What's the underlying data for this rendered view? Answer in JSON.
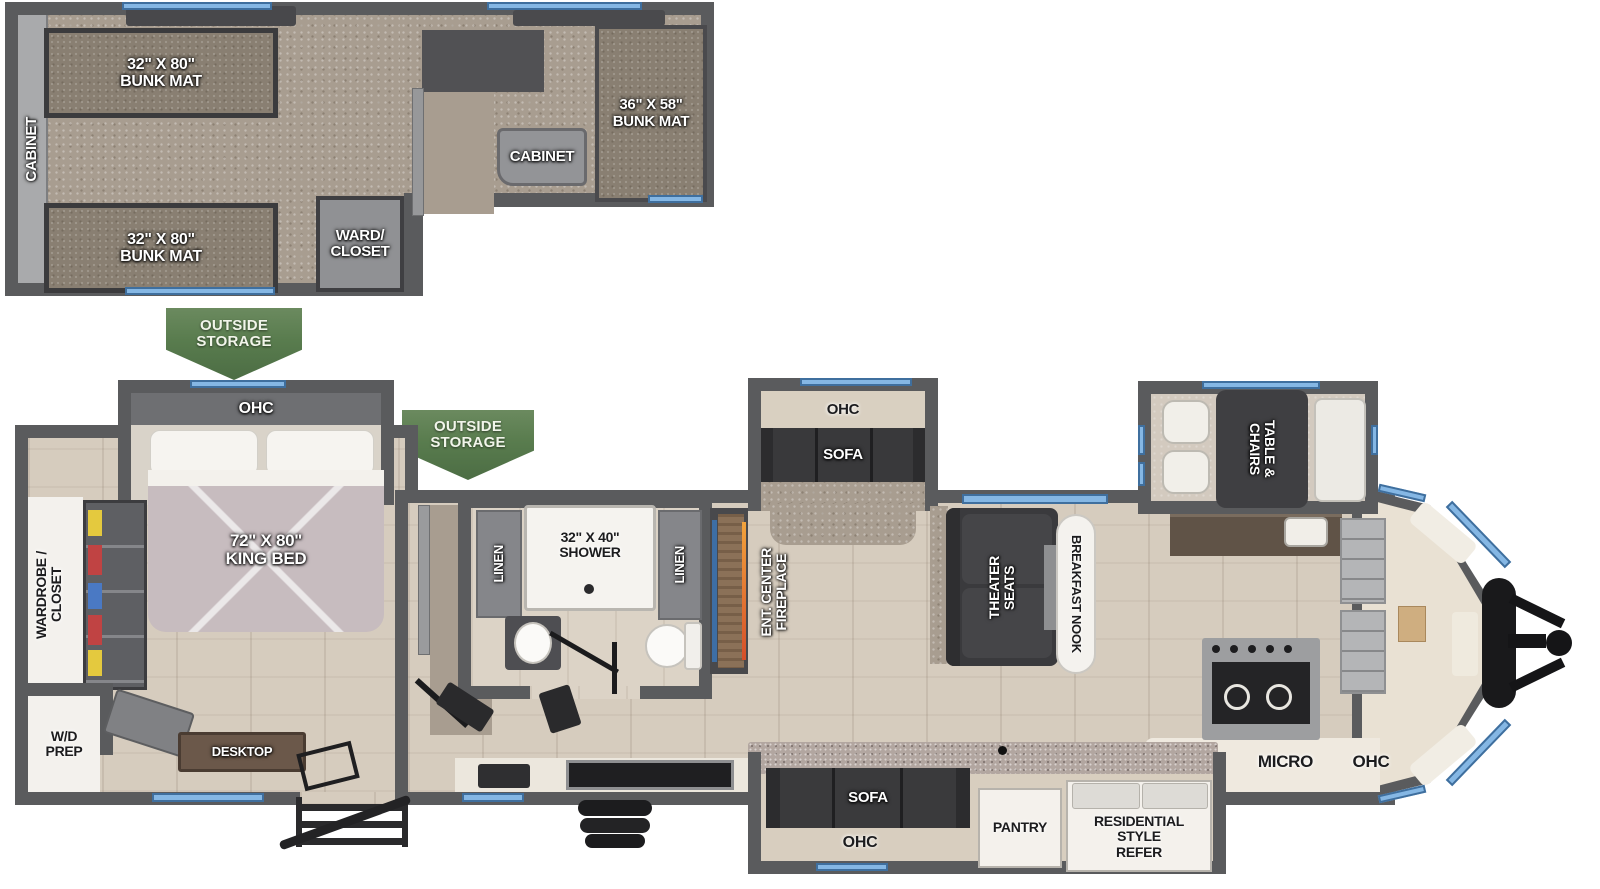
{
  "plan_title": "travel-trailer-floorplan",
  "colors": {
    "wall": "#5a5b5d",
    "window_blue": "#85b7e4",
    "banner_green": "#597c4e",
    "wood_floor": "#d6ccbe",
    "carpet": "#a89d90",
    "furniture_dark": "#3a3a3c",
    "quilt": "#c7bcbf",
    "flame_orange": "#e2742f",
    "tv_blue": "#3d6ea5"
  },
  "loft": {
    "cabinet_side": "CABINET",
    "bunk_mat_top": "32\" X 80\"\nBUNK MAT",
    "bunk_mat_bottom": "32\" X 80\"\nBUNK MAT",
    "cabinet_landing": "CABINET",
    "bunk_mat_front": "36\" X 58\"\nBUNK MAT",
    "ward_closet": "WARD/\nCLOSET"
  },
  "storage": {
    "banner1": "OUTSIDE\nSTORAGE",
    "banner2": "OUTSIDE\nSTORAGE"
  },
  "bedroom": {
    "ohc": "OHC",
    "king_bed": "72\" X 80\"\nKING BED",
    "wardrobe_closet": "WARDROBE /\nCLOSET",
    "wd_prep": "W/D\nPREP",
    "desktop": "DESKTOP"
  },
  "bathroom": {
    "linen_left": "LINEN",
    "shower": "32\" X 40\"\nSHOWER",
    "linen_right": "LINEN"
  },
  "living": {
    "ent_center_fireplace": "ENT. CENTER\nFIREPLACE",
    "slide_ohc": "OHC",
    "slide_sofa": "SOFA",
    "theater_seats": "THEATER\nSEATS",
    "breakfast_nook": "BREAKFAST NOOK"
  },
  "dinette": {
    "table_chairs": "TABLE &\nCHAIRS"
  },
  "kitchen": {
    "micro": "MICRO",
    "ohc": "OHC",
    "pantry": "PANTRY",
    "refer": "RESIDENTIAL\nSTYLE\nREFER"
  },
  "entry_slide": {
    "sofa": "SOFA",
    "ohc": "OHC"
  }
}
